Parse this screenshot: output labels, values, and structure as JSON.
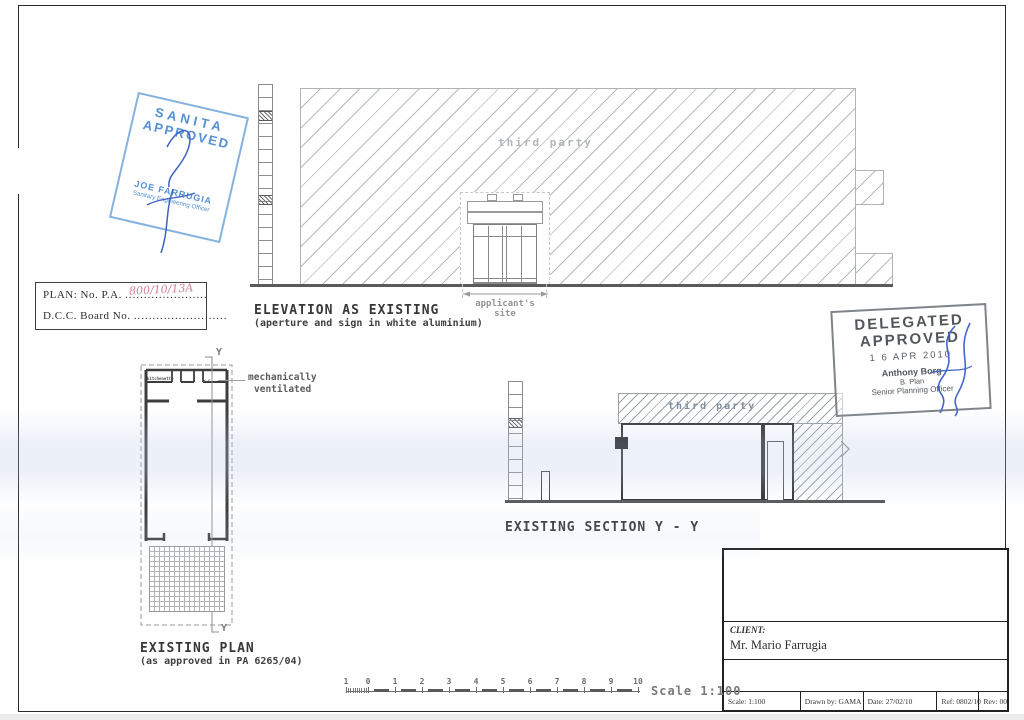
{
  "stamps": {
    "sanita": {
      "line1": "SANITA",
      "line2": "APPROVED",
      "name": "JOE FARRUGIA",
      "title": "Sanitary Engineering Officer"
    },
    "delegated": {
      "line1": "DELEGATED",
      "line2": "APPROVED",
      "date": "1 6 APR 2010",
      "name": "Anthony Borg",
      "qualification": "B. Plan",
      "title": "Senior Planning Officer"
    }
  },
  "plan_ref_box": {
    "plan_label": "PLAN:  No. P.A.",
    "plan_dots": "......................",
    "plan_number": "800/10/13A",
    "board_label": "D.C.C. Board No.",
    "board_dots": "........................."
  },
  "elevation": {
    "title": "ELEVATION AS EXISTING",
    "subtitle": "(aperture and sign in white aluminium)",
    "hatch_label": "third party",
    "dim_line1": "applicant's",
    "dim_line2": "site"
  },
  "floor_plan": {
    "title": "EXISTING PLAN",
    "subtitle": "(as approved in PA 6265/04)",
    "note_line1": "mechanically",
    "note_line2": "ventilated",
    "room1": "kitchenette",
    "room2": "w.c.",
    "marker": "Y"
  },
  "section": {
    "title": "EXISTING SECTION Y - Y",
    "hatch_label": "third party"
  },
  "title_block": {
    "client_label": "CLIENT:",
    "client_value": "Mr. Mario Farrugia",
    "scale": "Scale: 1:100",
    "drawn_by": "Drawn by: GAMA",
    "date": "Date:   27/02/10",
    "ref": "Ref: 0802/10",
    "rev": "Rev:  00"
  },
  "scale_bar": {
    "ticks": [
      "1",
      "0",
      "1",
      "2",
      "3",
      "4",
      "5",
      "6",
      "7",
      "8",
      "9",
      "10"
    ],
    "label": "Scale 1:100"
  },
  "colors": {
    "sanita_blue": "#5b97d2",
    "signature_blue": "#3f64c0",
    "handwriting_red": "#c86480",
    "stamp_gray": "#565b60",
    "line_dark": "#3a3a3a",
    "hatch_gray": "#b4b8bc"
  }
}
